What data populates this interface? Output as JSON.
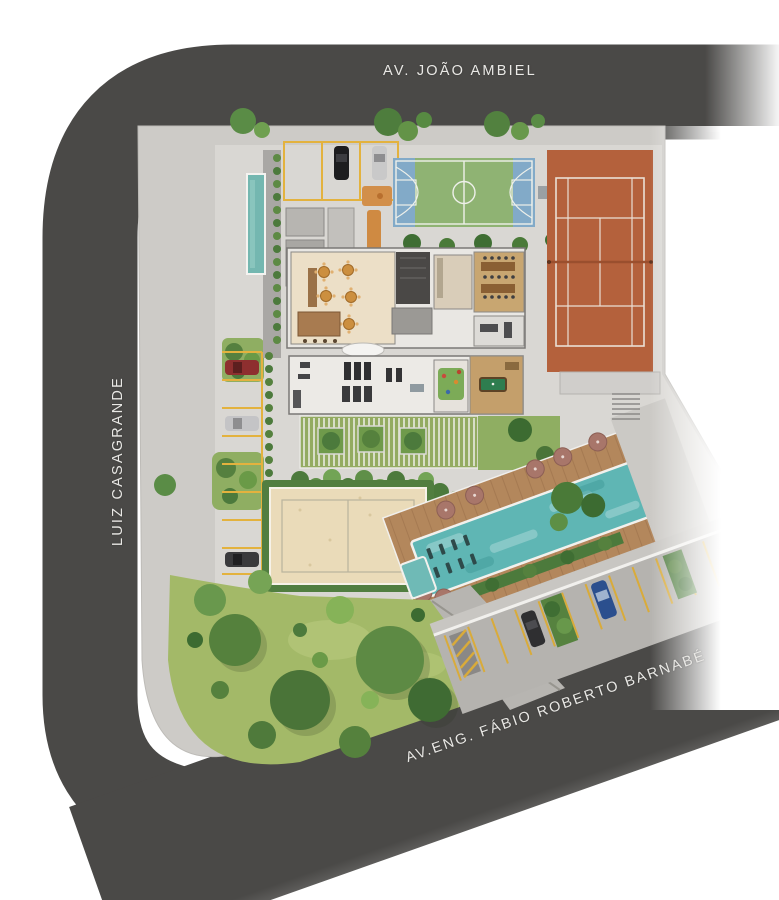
{
  "map": {
    "type": "architectural-site-plan",
    "streets": {
      "top_label": "AV. JOÃO AMBIEL",
      "left_label": "LUIZ CASAGRANDE",
      "bottom_label": "AV.ENG. FÁBIO ROBERTO BARNABÉ"
    },
    "amenities": [
      "covered-parking-stalls",
      "basketball-court",
      "tennis-court",
      "reflecting-pool-water-mirror",
      "party-room-with-tables",
      "bar-counter",
      "elevator-core",
      "dining-room",
      "gym",
      "kids-playroom",
      "game-room-billiards",
      "pergola-with-planters",
      "beach-volleyball-sand-court",
      "pool-deck-with-umbrellas",
      "swimming-pool-with-loungers",
      "kids-pool",
      "woodland-garden",
      "street-level-parking",
      "stairs",
      "playground-equipment"
    ],
    "vehicles": [
      {
        "color_name": "black",
        "location": "top-parking"
      },
      {
        "color_name": "silver",
        "location": "top-parking"
      },
      {
        "color_name": "red",
        "location": "left-parking"
      },
      {
        "color_name": "silver",
        "location": "left-parking"
      },
      {
        "color_name": "dark-gray",
        "location": "left-parking"
      },
      {
        "color_name": "blue",
        "location": "bottom-right-parking"
      },
      {
        "color_name": "dark-gray",
        "location": "bottom-right-parking"
      }
    ],
    "colors": {
      "road": "#4a4947",
      "sidewalk": "#cdcbc7",
      "plot_floor": "#d9d7d3",
      "lawn": "#96b061",
      "tree_dark": "#48703a",
      "sand": "#eadbb9",
      "pool_water": "#5fb6b4",
      "wood_deck": "#b3875c",
      "tennis_clay": "#b4613c",
      "court_green": "#8fb373",
      "court_blue": "#82aac8",
      "stall_yellow": "#e3b23e",
      "label_text": "#e9e8e5",
      "umbrella": "#a8766a"
    }
  }
}
